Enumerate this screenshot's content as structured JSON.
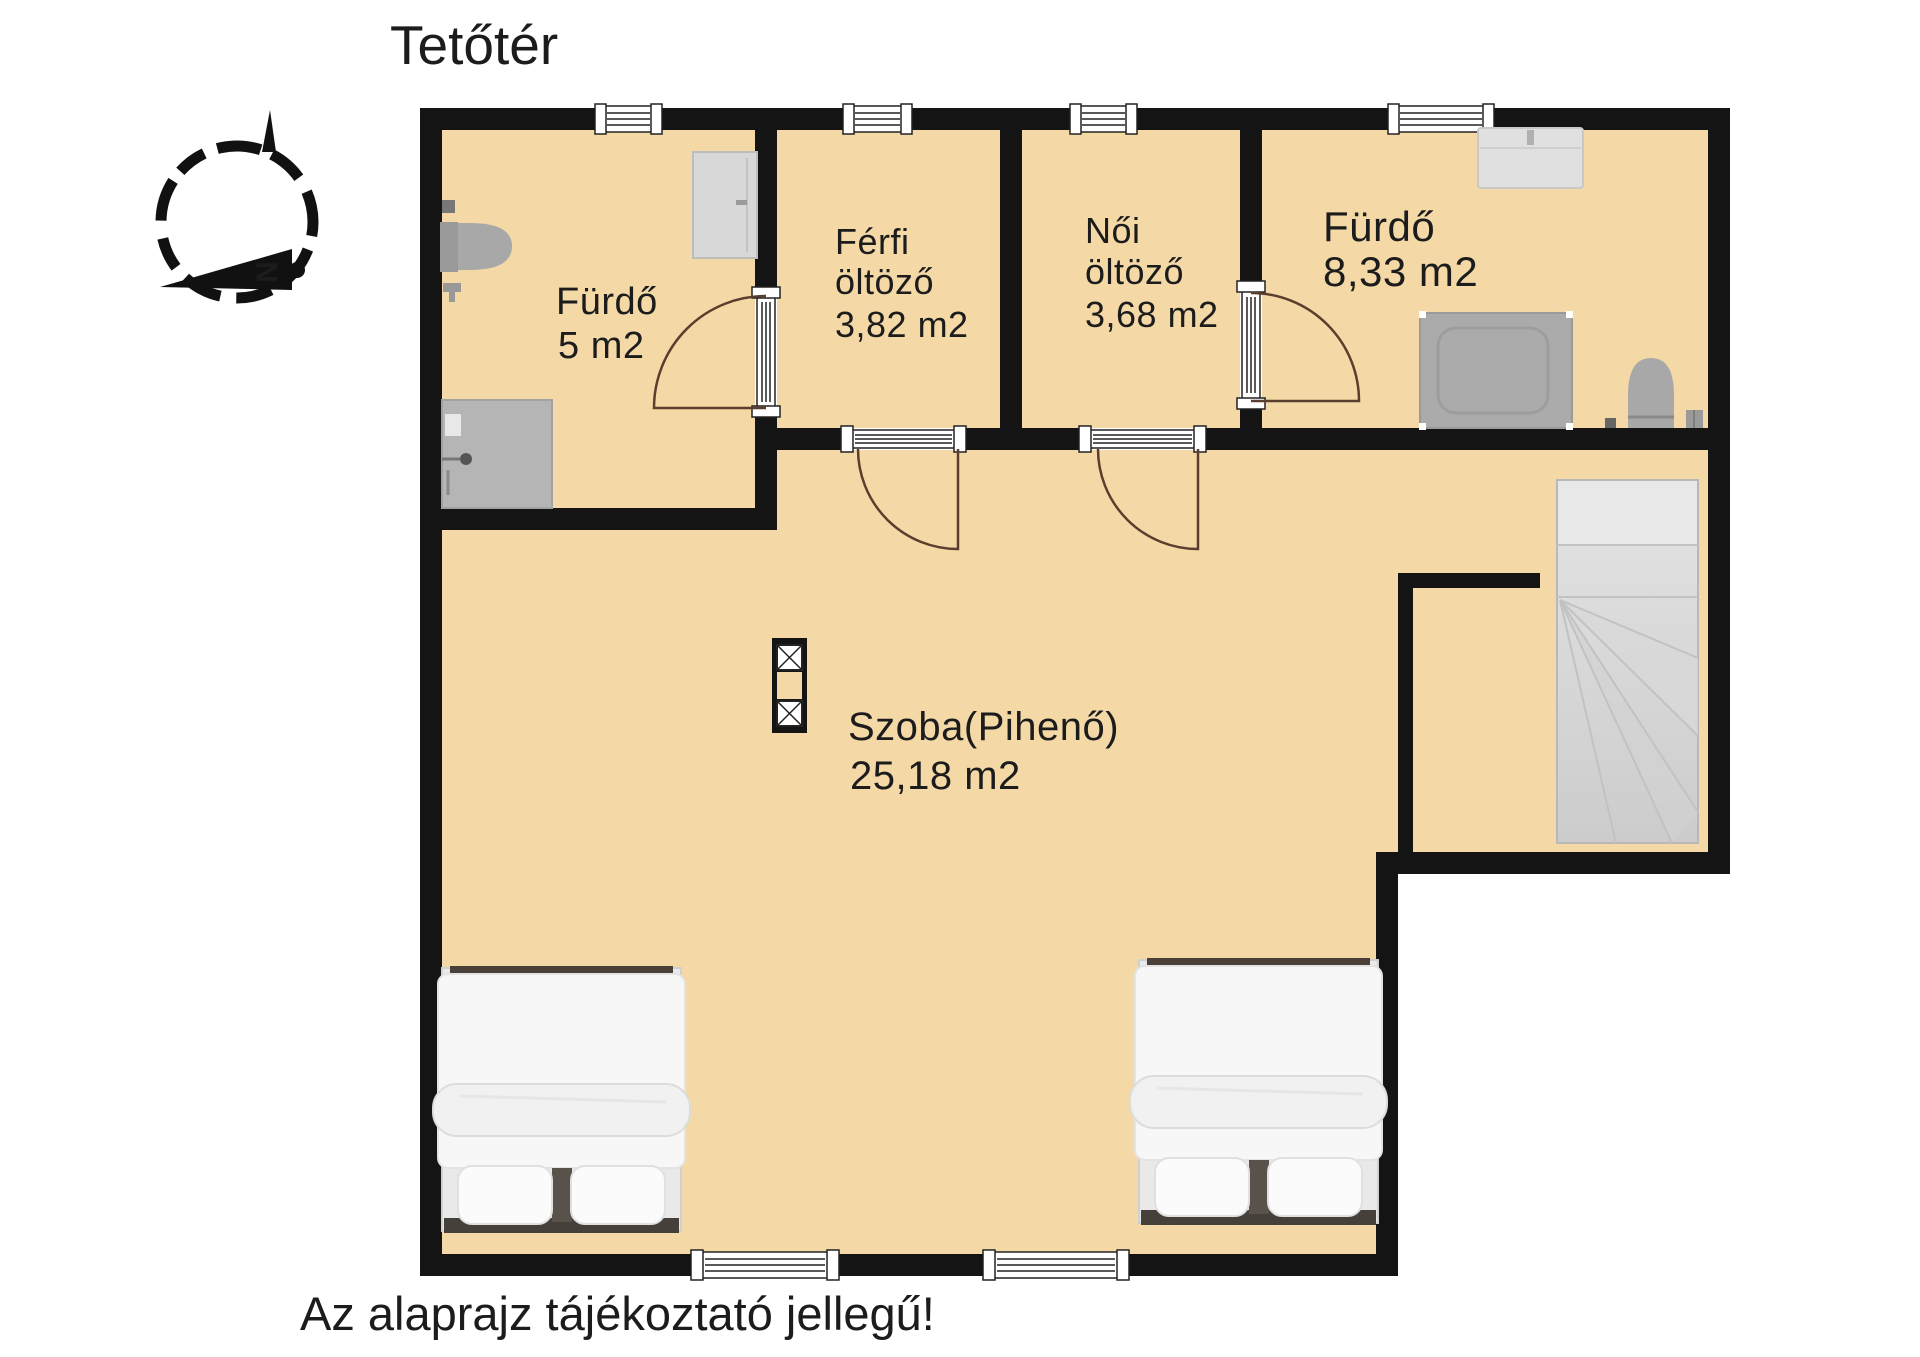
{
  "page": {
    "title": "Tetőtér",
    "disclaimer": "Az alaprajz tájékoztató jellegű!"
  },
  "compass": {
    "north_label": "N"
  },
  "rooms": {
    "bathroom_small": {
      "name": "Fürdő",
      "area": "5 m2"
    },
    "dressing_men": {
      "name": "Férfi",
      "subtitle": "öltöző",
      "area": "3,82 m2"
    },
    "dressing_women": {
      "name": "Női",
      "subtitle": "öltöző",
      "area": "3,68 m2"
    },
    "bathroom_large": {
      "name": "Fürdő",
      "area": "8,33 m2"
    },
    "main_room": {
      "name": "Szoba(Pihenő)",
      "area": "25,18 m2"
    }
  },
  "colors": {
    "floor": "#f4d9a7",
    "wall": "#141414",
    "door_arc": "#5a3f2e",
    "fixture_gray": "#ababab",
    "text": "#1c1c1c"
  }
}
